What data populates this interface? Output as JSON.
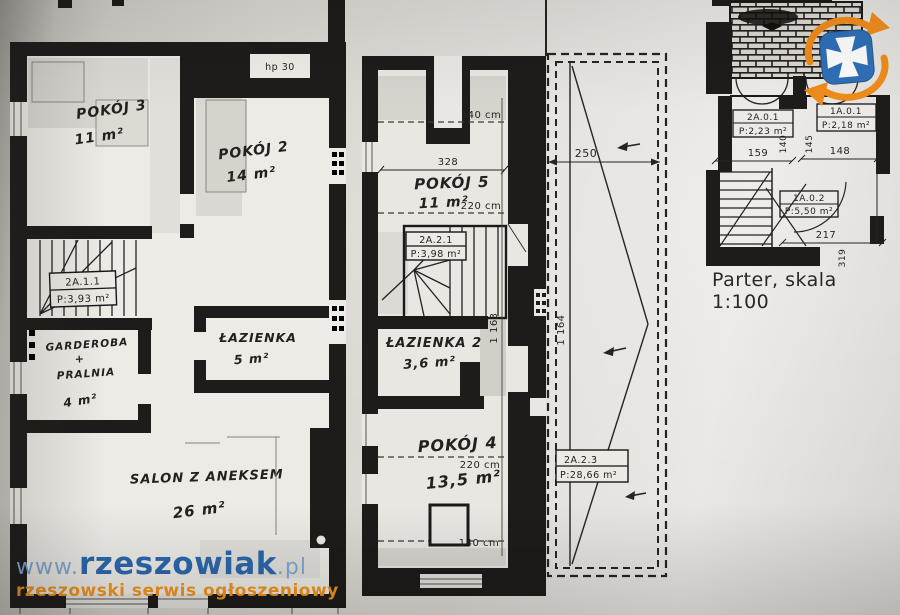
{
  "caption": "Parter, skala 1:100",
  "watermark": {
    "prefix": "www.",
    "name": "rzeszowiak",
    "tld": ".pl",
    "tagline": "rzeszowski serwis ogłoszeniowy"
  },
  "colors": {
    "ink": "#1e1c1a",
    "paper": "#dedbd6",
    "watermark_blue": "#2b67ad",
    "watermark_light_blue": "#7fa9d6",
    "watermark_orange": "#f0941f",
    "logo_blue": "#2f6fb7",
    "logo_orange": "#ee8b1c"
  },
  "floor1": {
    "marker": "hp 30",
    "room3": {
      "name": "POKÓJ 3",
      "area": "11 m²"
    },
    "room2": {
      "name": "POKÓJ 2",
      "area": "14 m²"
    },
    "stairs": {
      "id": "2A.1.1",
      "area": "P:3,93 m²"
    },
    "wardrobe": {
      "line1": "GARDEROBA",
      "line2": "+",
      "line3": "PRALNIA",
      "area": "4 m²"
    },
    "bath": {
      "name": "ŁAZIENKA",
      "area": "5 m²"
    },
    "salon": {
      "name": "SALON Z ANEKSEM",
      "area": "26 m²"
    }
  },
  "floor2": {
    "h140_top": "140 cm",
    "w328": "328",
    "room5": {
      "name": "POKÓJ 5",
      "area": "11 m²",
      "h": "220 cm"
    },
    "stairs": {
      "id": "2A.2.1",
      "area": "P:3,98 m²"
    },
    "bath2": {
      "name": "ŁAZIENKA 2",
      "area": "3,6 m²"
    },
    "room4": {
      "name": "POKÓJ 4",
      "h": "220 cm",
      "area": "13,5 m²",
      "h2": "140 cm"
    },
    "dim_height": "1 163",
    "terrace": {
      "w": "250",
      "dim_height": "1 164",
      "id": "2A.2.3",
      "area": "P:28,66 m²"
    }
  },
  "parter": {
    "r1": {
      "id": "2A.0.1",
      "area": "P:2,23 m²"
    },
    "r2": {
      "id": "1A.0.1",
      "area": "P:2,18 m²"
    },
    "r3": {
      "id": "1A.0.2",
      "area": "P:5,50 m²"
    },
    "dims": {
      "d159": "159",
      "d140": "140",
      "d148": "148",
      "d145": "145",
      "d217": "217",
      "d319": "319"
    }
  }
}
